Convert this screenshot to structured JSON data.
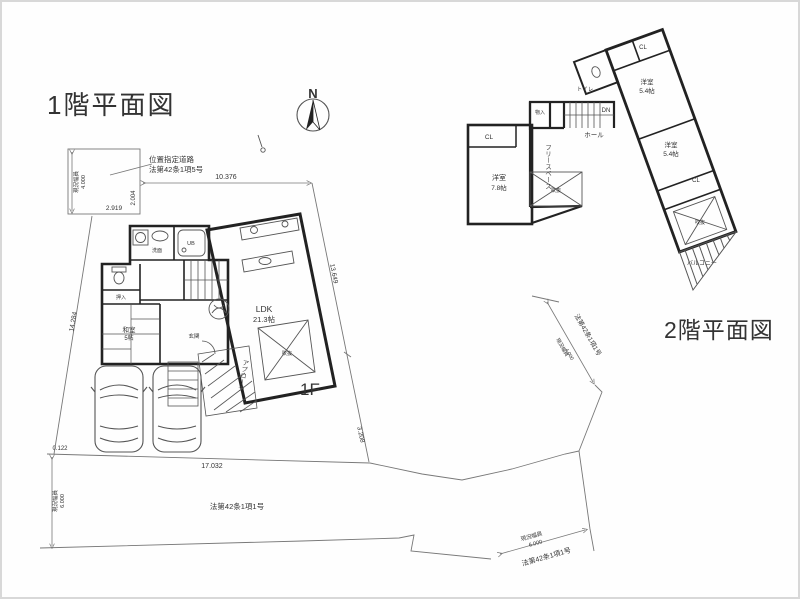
{
  "titles": {
    "floor1": "1階平面図",
    "floor2": "2階平面図",
    "floor1_mark": "1F",
    "north": "N"
  },
  "site": {
    "top_road": {
      "note1": "位置指定道路",
      "note2": "法第42条1項5号",
      "width_name": "現況幅員",
      "width_value": "4.000",
      "dim_width": "2.919",
      "dim_height": "2.004"
    },
    "dims": {
      "north_edge": "10.376",
      "west_edge": "14.284",
      "east_edge_upper": "13.649",
      "east_edge_lower": "3.208",
      "south_offset": "0.122",
      "south_edge": "17.032"
    },
    "west_road": {
      "width_name": "現況幅員",
      "width_value": "6.000"
    },
    "south_road": {
      "law": "法第42条1項1号"
    },
    "southeast_road": {
      "width_name": "現況幅員",
      "width_value": "6.000",
      "law": "法第42条1項1号"
    },
    "east_road": {
      "width_name": "現況幅員",
      "width_value": "4.000",
      "law": "法第42条1項1号"
    }
  },
  "floor1": {
    "ldk_name": "LDK",
    "ldk_size": "21.3帖",
    "washitsu_name": "和室",
    "washitsu_size": "5帖",
    "oshiire": "押入",
    "genkan": "玄関",
    "senmen": "洗面",
    "ub": "UB",
    "void": "吹抜",
    "approach": "アプローチ"
  },
  "floor2": {
    "bed1_name": "洋室",
    "bed1_size": "7.8帖",
    "bed2_name": "洋室",
    "bed2_size": "5.4帖",
    "bed3_name": "洋室",
    "bed3_size": "5.4帖",
    "cl": "CL",
    "toilet": "トイレ",
    "hall": "ホール",
    "dn": "DN",
    "mono": "物入",
    "free_space": "フリースペース",
    "void": "吹抜",
    "balcony": "バルコニー"
  }
}
